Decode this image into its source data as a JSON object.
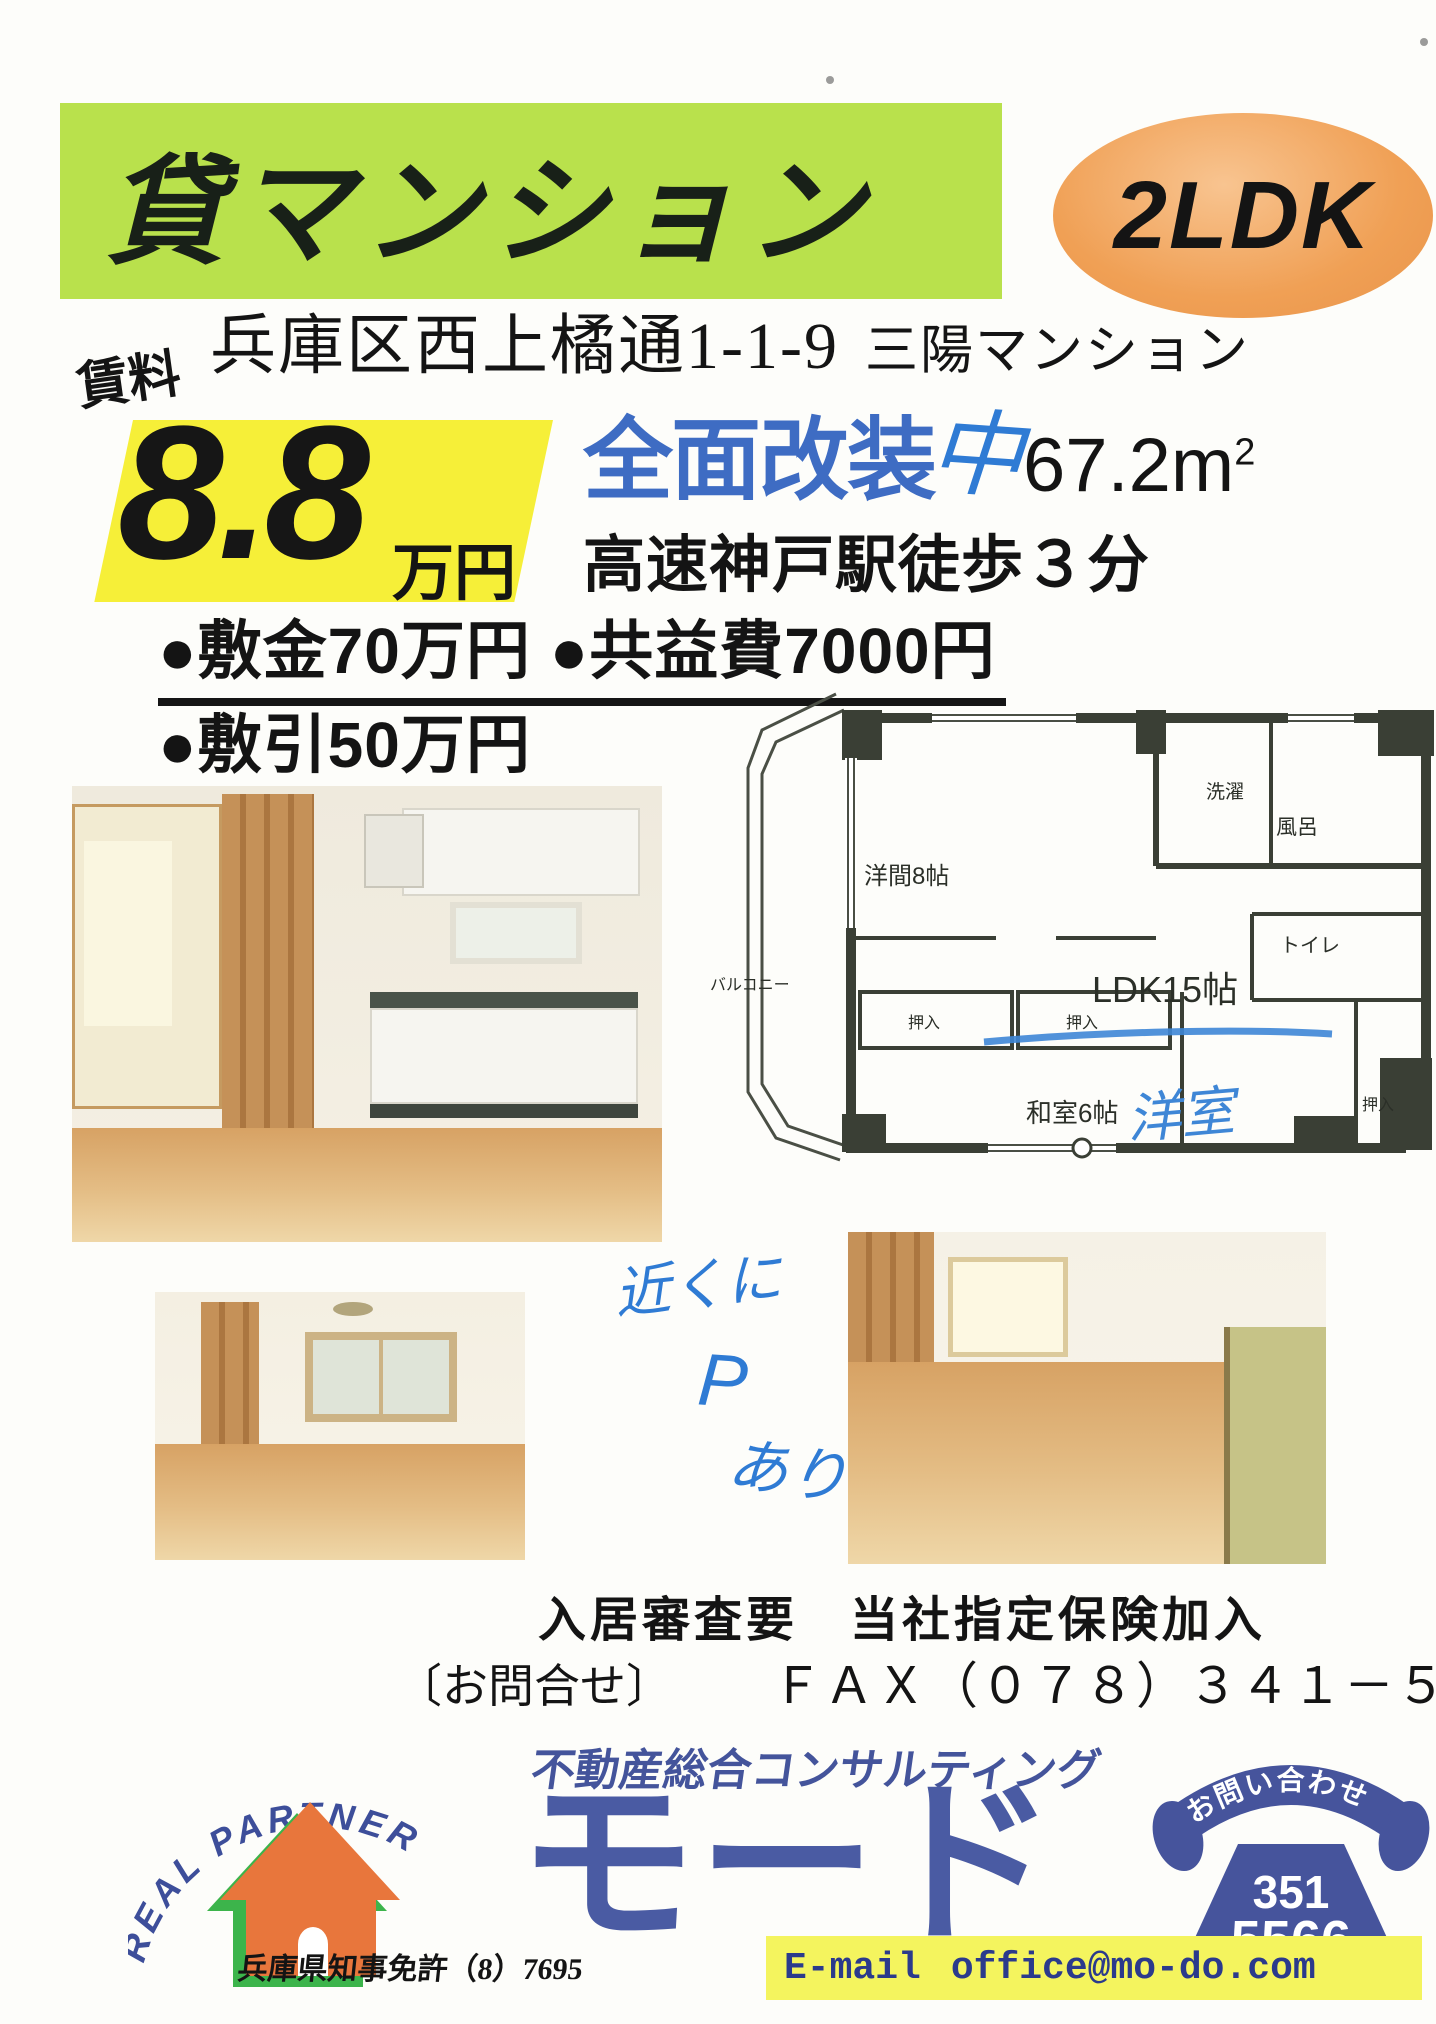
{
  "colors": {
    "banner_green": "#b9e14c",
    "badge_orange": "#f0a055",
    "price_yellow": "#f6ef38",
    "renovation_blue": "#3e6cc3",
    "handwriting_blue": "#2f7bd4",
    "logo_navy": "#46549c",
    "house_orange": "#e8763c",
    "house_green": "#3cb44b",
    "email_yellow": "#f4f45e"
  },
  "header": {
    "banner": "貸マンション",
    "badge": "2LDK"
  },
  "listing": {
    "rent_label": "賃料",
    "address": "兵庫区西上橘通1-1-9",
    "building": "三陽マンション",
    "rent_value": "8.8",
    "rent_unit": "万円",
    "renovation": "全面改装",
    "renovation_hand": "中",
    "area": "67.2m",
    "area_sup": "2",
    "access": "高速神戸駅徒歩３分",
    "terms1": "●敷金70万円 ●共益費7000円",
    "terms2": "●敷引50万円"
  },
  "floor_plan": {
    "balcony": "バルコニー",
    "western_room": "洋間8帖",
    "laundry": "洗濯",
    "bath": "風呂",
    "toilet": "トイレ",
    "ldk": "LDK15帖",
    "closet1": "押入",
    "closet2": "押入",
    "closet3": "押入",
    "japanese_room": "和室6帖",
    "hand_note": "洋室"
  },
  "hand_note": {
    "line1": "近くに",
    "line2": "P",
    "line3": "あり"
  },
  "contact": {
    "screening": "入居審査要　当社指定保険加入",
    "inquiry_label": "〔お問合せ〕",
    "fax": "ＦＡＸ（０７８）３４１－５４７",
    "tagline": "不動産総合コンサルティング",
    "brand_arc": "REAL PARTNER",
    "company": "モード",
    "phone_label": "お問い合わせ",
    "phone_number_top": "351",
    "phone_number_bottom": "5566",
    "email_label": "E-mail",
    "email": "office@mo-do.com",
    "license": "兵庫県知事免許（8）7695"
  }
}
